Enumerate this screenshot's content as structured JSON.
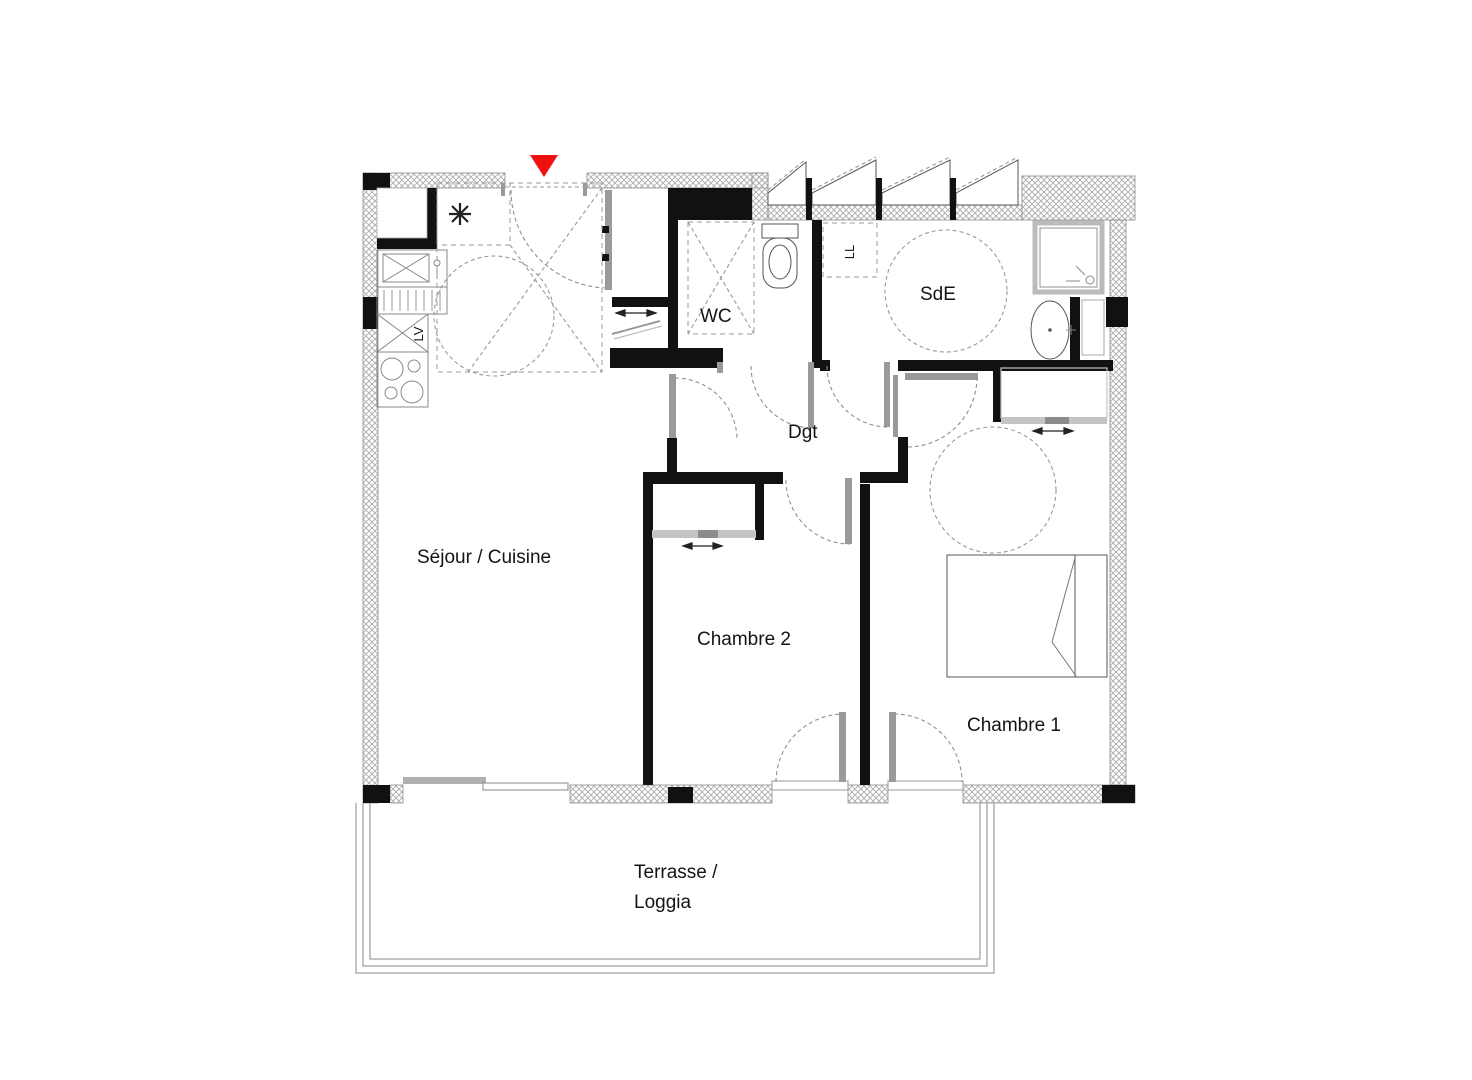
{
  "page": {
    "background": "#ffffff",
    "type": "architectural-floor-plan"
  },
  "plan": {
    "entrance_marker_color": "#f01010",
    "labels": {
      "sejour": "Séjour / Cuisine",
      "chambre2": "Chambre 2",
      "chambre1": "Chambre 1",
      "wc": "WC",
      "sde": "SdE",
      "dgt": "Dgt",
      "terrasse_line1": "Terrasse /",
      "terrasse_line2": "Loggia"
    },
    "appliance_labels": {
      "dishwasher": "LV",
      "washing_machine": "LL",
      "water_heater_symbol": "*"
    }
  }
}
